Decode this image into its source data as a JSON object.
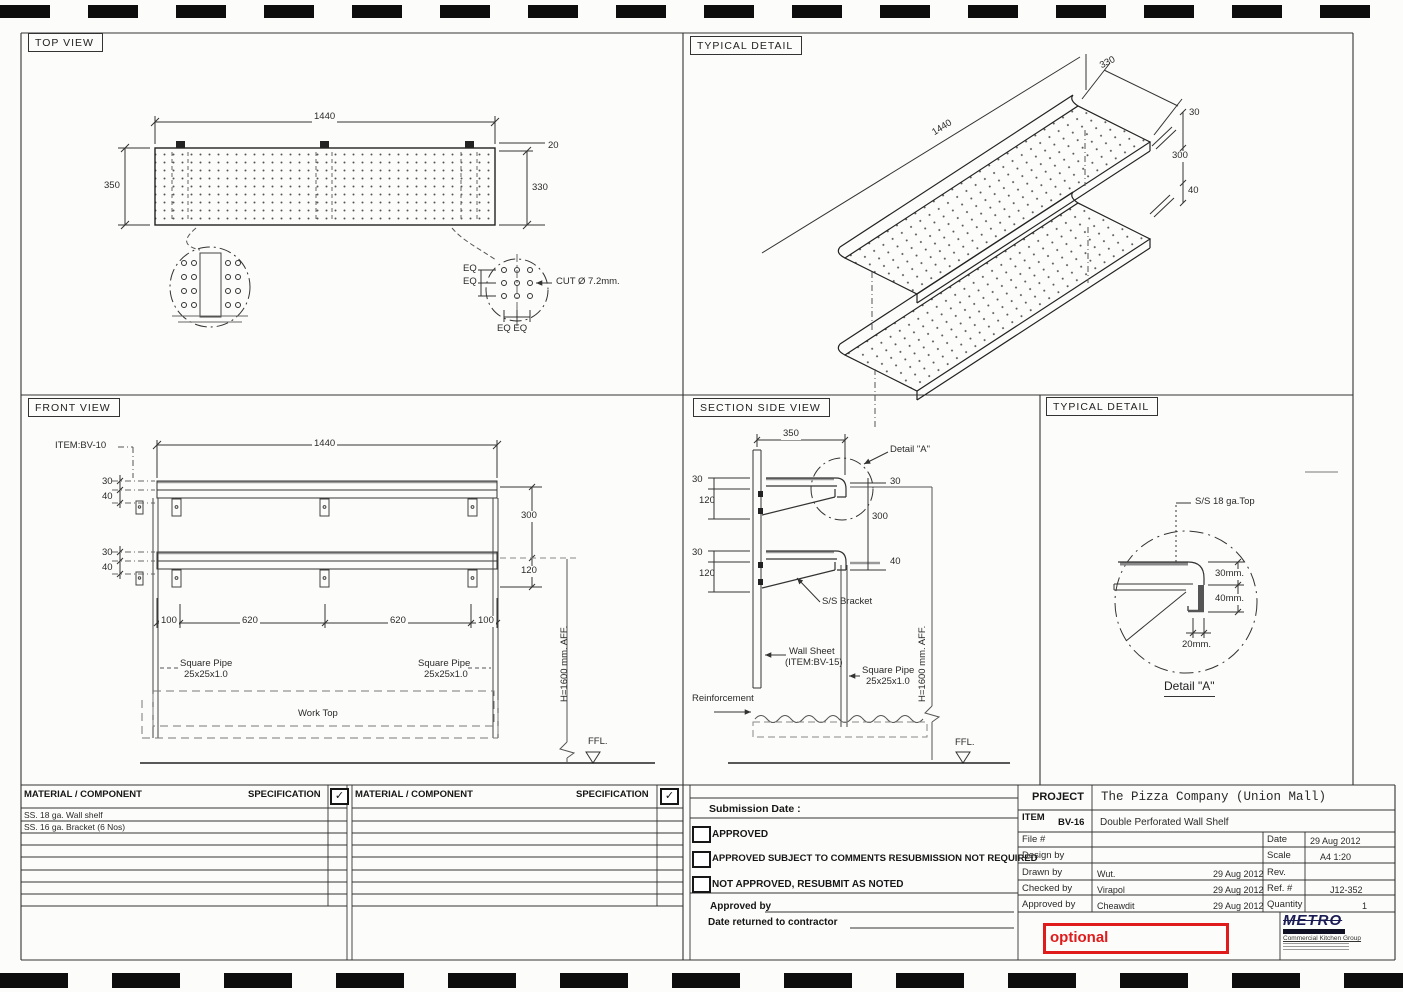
{
  "views": {
    "top": {
      "title": "TOP VIEW",
      "d_len": "1440",
      "d_depth": "350",
      "d_edge": "20",
      "d_inner": "330",
      "eq": "EQ",
      "eq_pair": "EQ EQ",
      "cut": "CUT Ø 7.2mm."
    },
    "iso": {
      "title": "TYPICAL DETAIL",
      "d_depth": "330",
      "d_len": "1440",
      "d_lip": "30",
      "d_gap": "300",
      "d_lower": "40"
    },
    "front": {
      "title": "FRONT VIEW",
      "item": "ITEM:BV-10",
      "d_len": "1440",
      "d_30": "30",
      "d_40": "40",
      "d_gap": "300",
      "d_120": "120",
      "d_100": "100",
      "d_620": "620",
      "pipe1": "Square Pipe",
      "pipe2": "25x25x1.0",
      "worktop": "Work Top",
      "height": "H=1600 mm. AFF.",
      "ffl": "FFL."
    },
    "section": {
      "title": "SECTION SIDE VIEW",
      "d_350": "350",
      "detail_ref": "Detail \"A\"",
      "d_30": "30",
      "d_120": "120",
      "d_gap": "300",
      "d_40": "40",
      "bracket": "S/S Bracket",
      "wallsheet1": "Wall Sheet",
      "wallsheet2": "(ITEM:BV-15)",
      "pipe1": "Square Pipe",
      "pipe2": "25x25x1.0",
      "height": "H=1600 mm. AFF.",
      "reinforcement": "Reinforcement",
      "ffl": "FFL."
    },
    "detail": {
      "title": "TYPICAL DETAIL",
      "callout": "S/S 18 ga.Top",
      "d_30": "30mm.",
      "d_40": "40mm.",
      "d_20": "20mm.",
      "caption": "Detail \"A\""
    }
  },
  "materials": {
    "header_component": "MATERIAL / COMPONENT",
    "header_spec": "SPECIFICATION",
    "check": "✓",
    "rows": [
      "SS. 18 ga. Wall shelf",
      "SS. 16 ga. Bracket (6 Nos)"
    ]
  },
  "submission": {
    "date_label": "Submission Date :",
    "options": [
      "APPROVED",
      "APPROVED SUBJECT TO COMMENTS RESUBMISSION NOT REQUIRED",
      "NOT APPROVED, RESUBMIT AS NOTED"
    ],
    "approved_by": "Approved by",
    "date_returned": "Date returned to contractor"
  },
  "title_block": {
    "project_label": "PROJECT",
    "project": "The Pizza Company (Union Mall)",
    "item_label": "ITEM",
    "item_code": "BV-16",
    "item_desc": "Double Perforated Wall Shelf",
    "file_label": "File #",
    "date_label": "Date",
    "date": "29 Aug 2012",
    "design_label": "Design by",
    "scale_label": "Scale",
    "scale": "A4 1:20",
    "drawn_label": "Drawn by",
    "drawn_name": "Wut.",
    "drawn_date": "29 Aug 2012",
    "rev_label": "Rev.",
    "checked_label": "Checked by",
    "checked_name": "Virapol",
    "checked_date": "29 Aug 2012",
    "ref_label": "Ref. #",
    "ref": "J12-352",
    "approved_label": "Approved by",
    "approved_name": "Cheawdit",
    "approved_date": "29 Aug 2012",
    "qty_label": "Quantity",
    "qty": "1"
  },
  "logo": {
    "name": "METRO",
    "subtitle": "Commercial Kitchen Group"
  },
  "annotation": {
    "text": "optional",
    "color": "#e01b1b"
  }
}
